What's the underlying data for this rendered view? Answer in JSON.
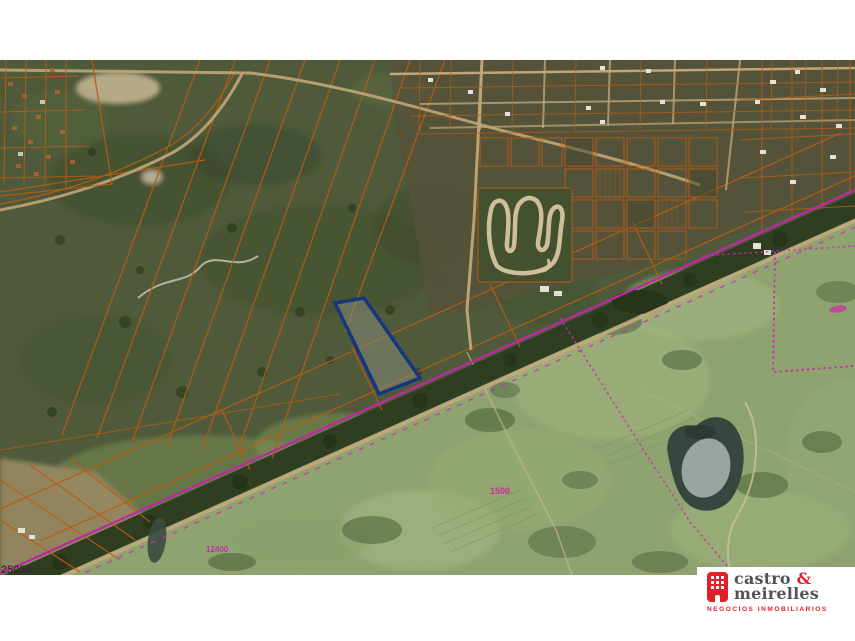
{
  "window": {
    "width": 855,
    "height": 641,
    "background": "#ffffff"
  },
  "map": {
    "type": "satellite-cadastral",
    "labels": [
      {
        "id": "parcel-number",
        "text": "25056",
        "color": "#33302a"
      },
      {
        "id": "measure-1",
        "text": "1500",
        "color": "#c52f9f"
      },
      {
        "id": "measure-2",
        "text": "12400",
        "color": "#c52f9f"
      }
    ],
    "highlight_parcel": {
      "points": "335,243 364,238 420,318 379,334",
      "stroke": "#16367e",
      "fill_hint": "#8a8d7e"
    },
    "colors": {
      "scrub_green": "#4e5a3a",
      "farmland_green": "#8fa370",
      "corridor_trees": "#2f3d20",
      "cadastral_orange": "#b85c15",
      "survey_magenta": "#c733a8",
      "road_tan": "#c2a87c",
      "water": "#37463f"
    }
  },
  "logo": {
    "name_part1": "castro ",
    "ampersand": "&",
    "name_part2": "meirelles",
    "tagline": "NEGOCIOS INMOBILIARIOS",
    "brand_red": "#e22028",
    "brand_gray": "#545456"
  }
}
